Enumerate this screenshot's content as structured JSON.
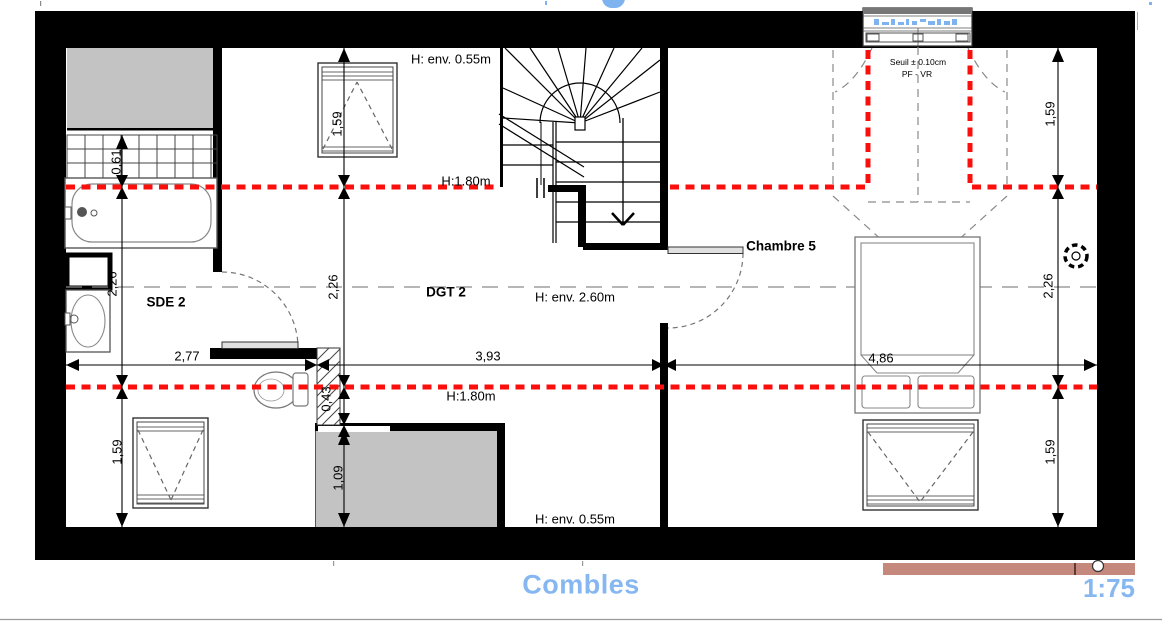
{
  "page": {
    "title": "Combles",
    "scale": "1:75",
    "title_color": "#86b7f1"
  },
  "rooms": {
    "sde2": "SDE 2",
    "dgt2": "DGT 2",
    "chambre5": "Chambre 5"
  },
  "height_labels": {
    "top_low": "H: env. 0.55m",
    "left_180": "H:1.80m",
    "mid_260": "H: env. 2.60m",
    "bottom_180": "H:1.80m",
    "bottom_low": "H: env. 0.55m"
  },
  "annotations": {
    "seuil": "Seuil ± 0.10cm",
    "pf_vr": "PF - VR"
  },
  "dimensions": {
    "d061": "0,61",
    "d226_left": "2,26",
    "d159_bottom_left": "1,59",
    "d159_top_mid": "1,59",
    "d226_mid": "2,26",
    "d043": "0,43",
    "d109": "1,09",
    "d159_top_right": "1,59",
    "d226_right": "2,26",
    "d159_bottom_right": "1,59",
    "d277": "2,77",
    "d393": "3,93",
    "d486": "4,86"
  },
  "colors": {
    "wall": "#000000",
    "red_level_line": "#fa0f0c",
    "gray_fill": "#c3c3c3",
    "terrace_bar": "#c4887c",
    "title_blue": "#86b7f1",
    "dashed_gray": "#8a8a8a"
  }
}
